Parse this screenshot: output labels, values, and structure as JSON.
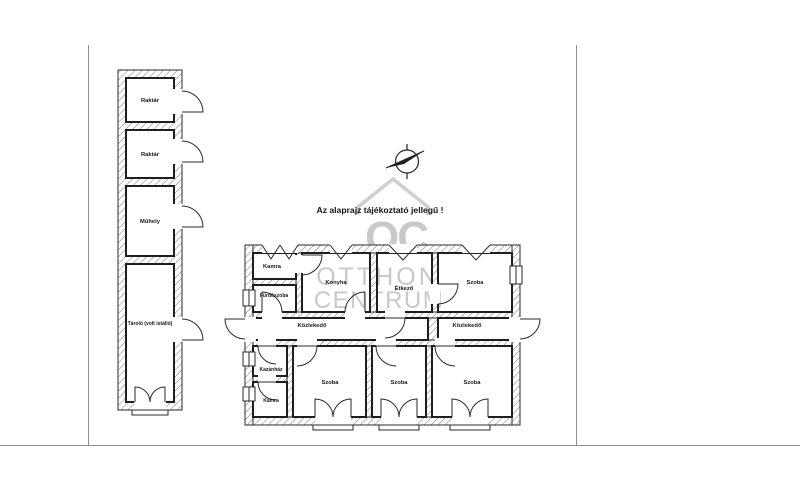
{
  "page": {
    "disclaimer": "Az alaprajz tájékoztató jellegű !"
  },
  "watermark": {
    "logo": "OC",
    "line1": "OTTHON",
    "line2": "CENTRUM"
  },
  "outbuilding": {
    "rooms": [
      {
        "label": "Raktár"
      },
      {
        "label": "Raktár"
      },
      {
        "label": "Műhely"
      },
      {
        "label": "Tároló (volt istálló)"
      }
    ]
  },
  "main_building": {
    "rooms": [
      {
        "label": "Kamra"
      },
      {
        "label": "Fürdőszoba"
      },
      {
        "label": "Konyha"
      },
      {
        "label": "Étkező"
      },
      {
        "label": "Szoba"
      },
      {
        "label": "Közlekedő"
      },
      {
        "label": "Közlekedő"
      },
      {
        "label": "Kazánház"
      },
      {
        "label": "Kamra"
      },
      {
        "label": "Szoba"
      },
      {
        "label": "Szoba"
      },
      {
        "label": "Szoba"
      }
    ]
  },
  "colors": {
    "line": "#1f1f1f",
    "hatch": "#6e6e6e",
    "frame": "#8f8f8f",
    "watermark": "#c9c9c9",
    "background": "#ffffff"
  }
}
